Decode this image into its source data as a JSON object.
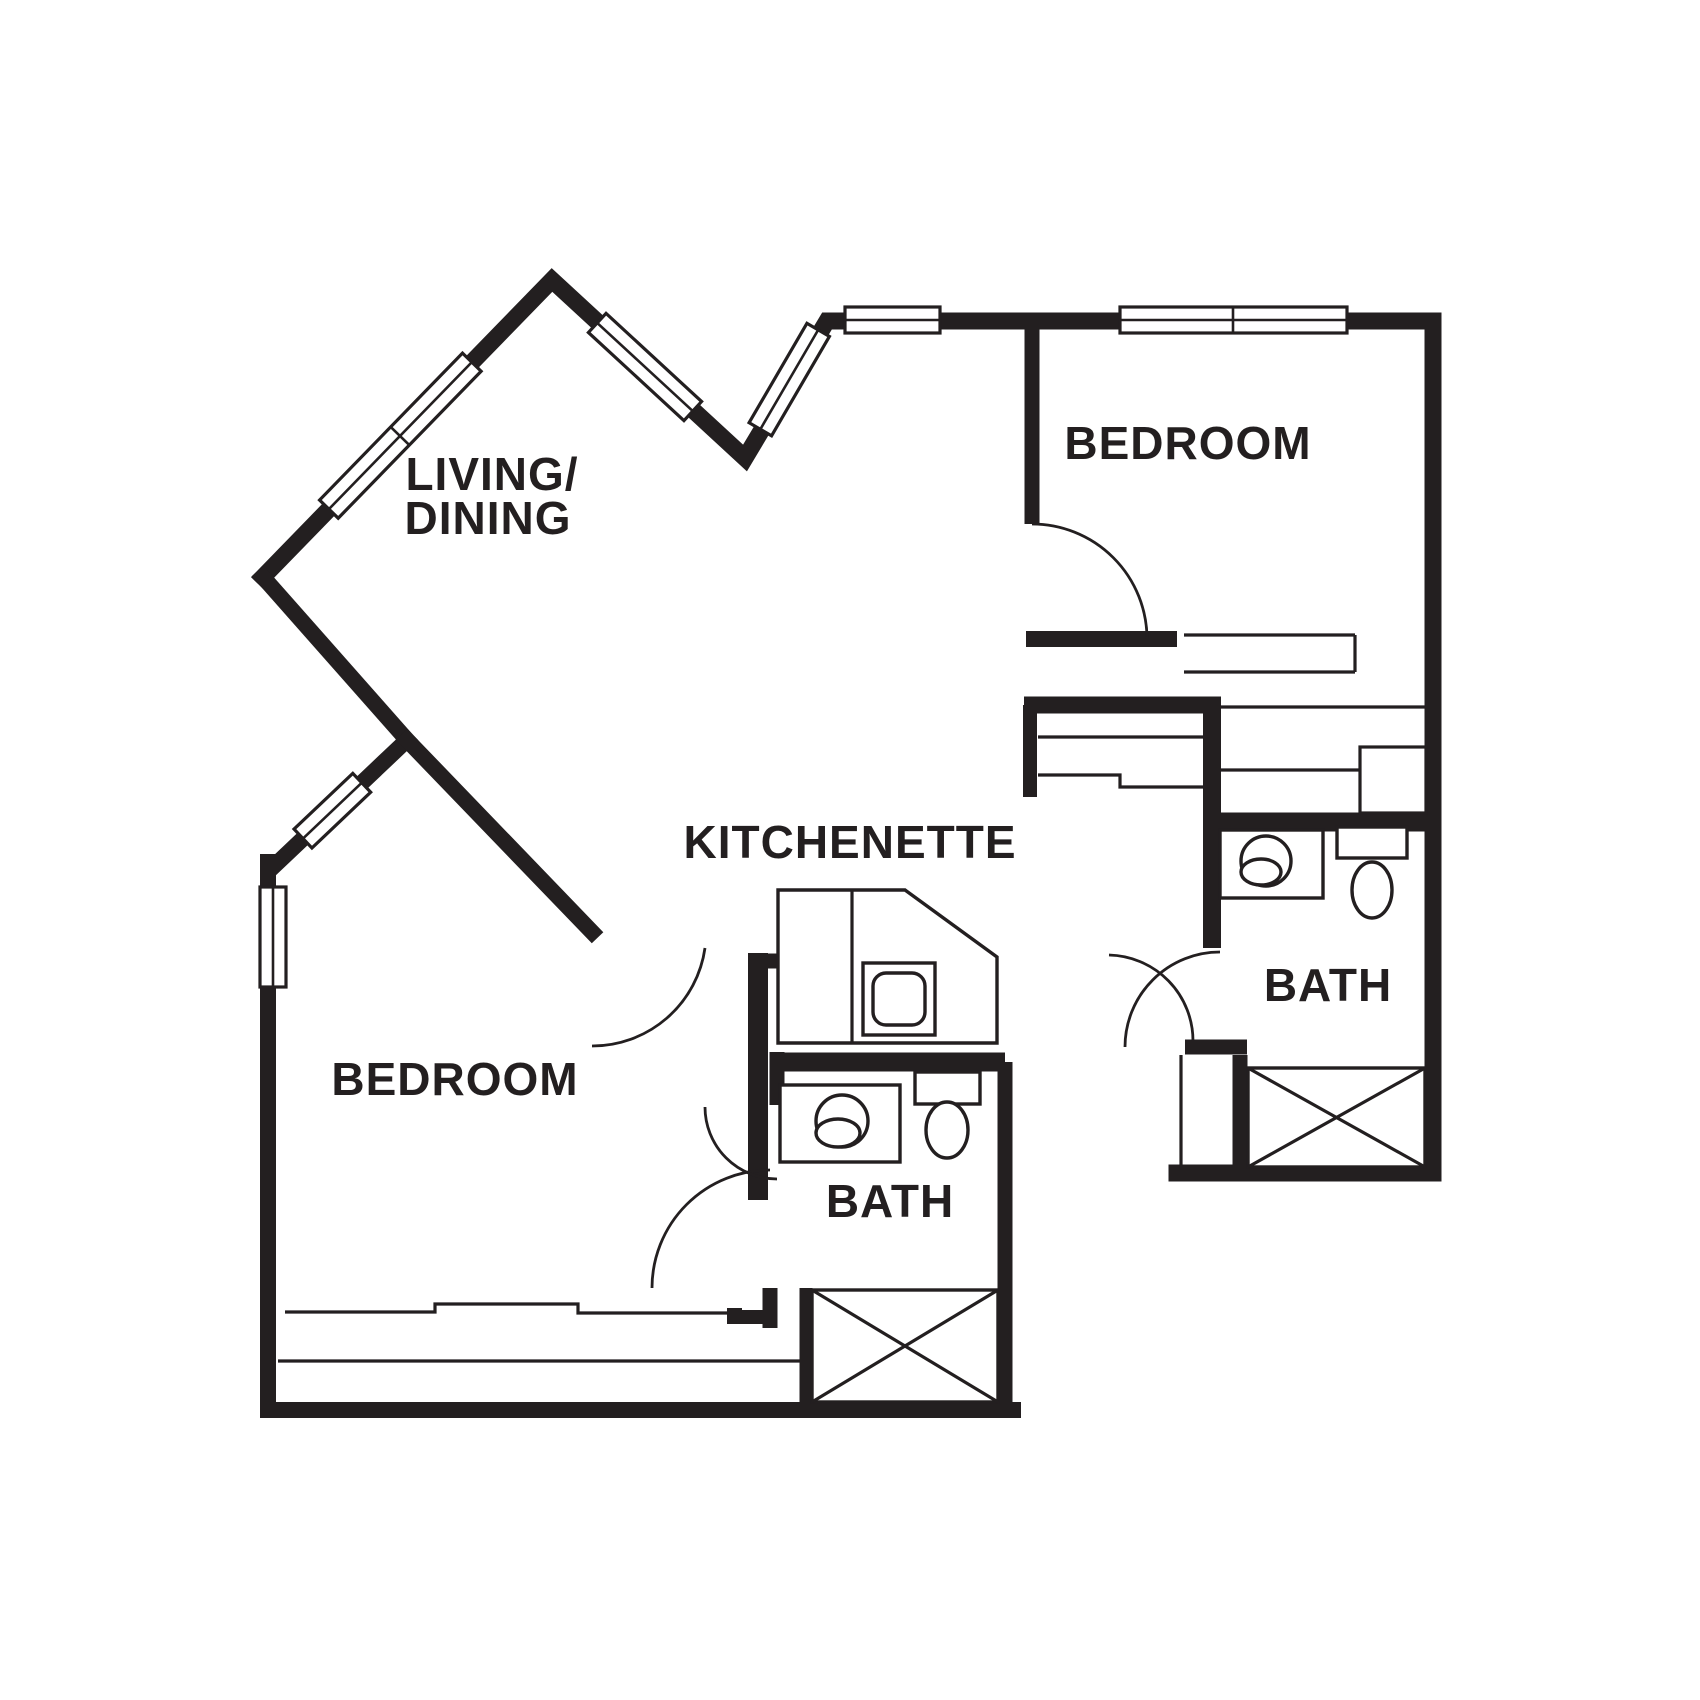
{
  "document": {
    "type": "apartment floor plan drawing",
    "background": "#ffffff"
  },
  "colors": {
    "wall": "#231f20",
    "background": "#ffffff"
  },
  "labels": {
    "living_dining_line1": "LIVING/",
    "living_dining_line2": "DINING",
    "bedroom_top": "BEDROOM",
    "kitchenette": "KITCHENETTE",
    "bath_right": "BATH",
    "bedroom_bottom": "BEDROOM",
    "bath_bottom": "BATH"
  },
  "fixtures_visible": {
    "bathtubs": 2,
    "toilets": 2,
    "sinks": 3,
    "kitchenette_counter": 1,
    "windows": 7,
    "door_swings": 6,
    "closet_shelving_areas": 3
  }
}
